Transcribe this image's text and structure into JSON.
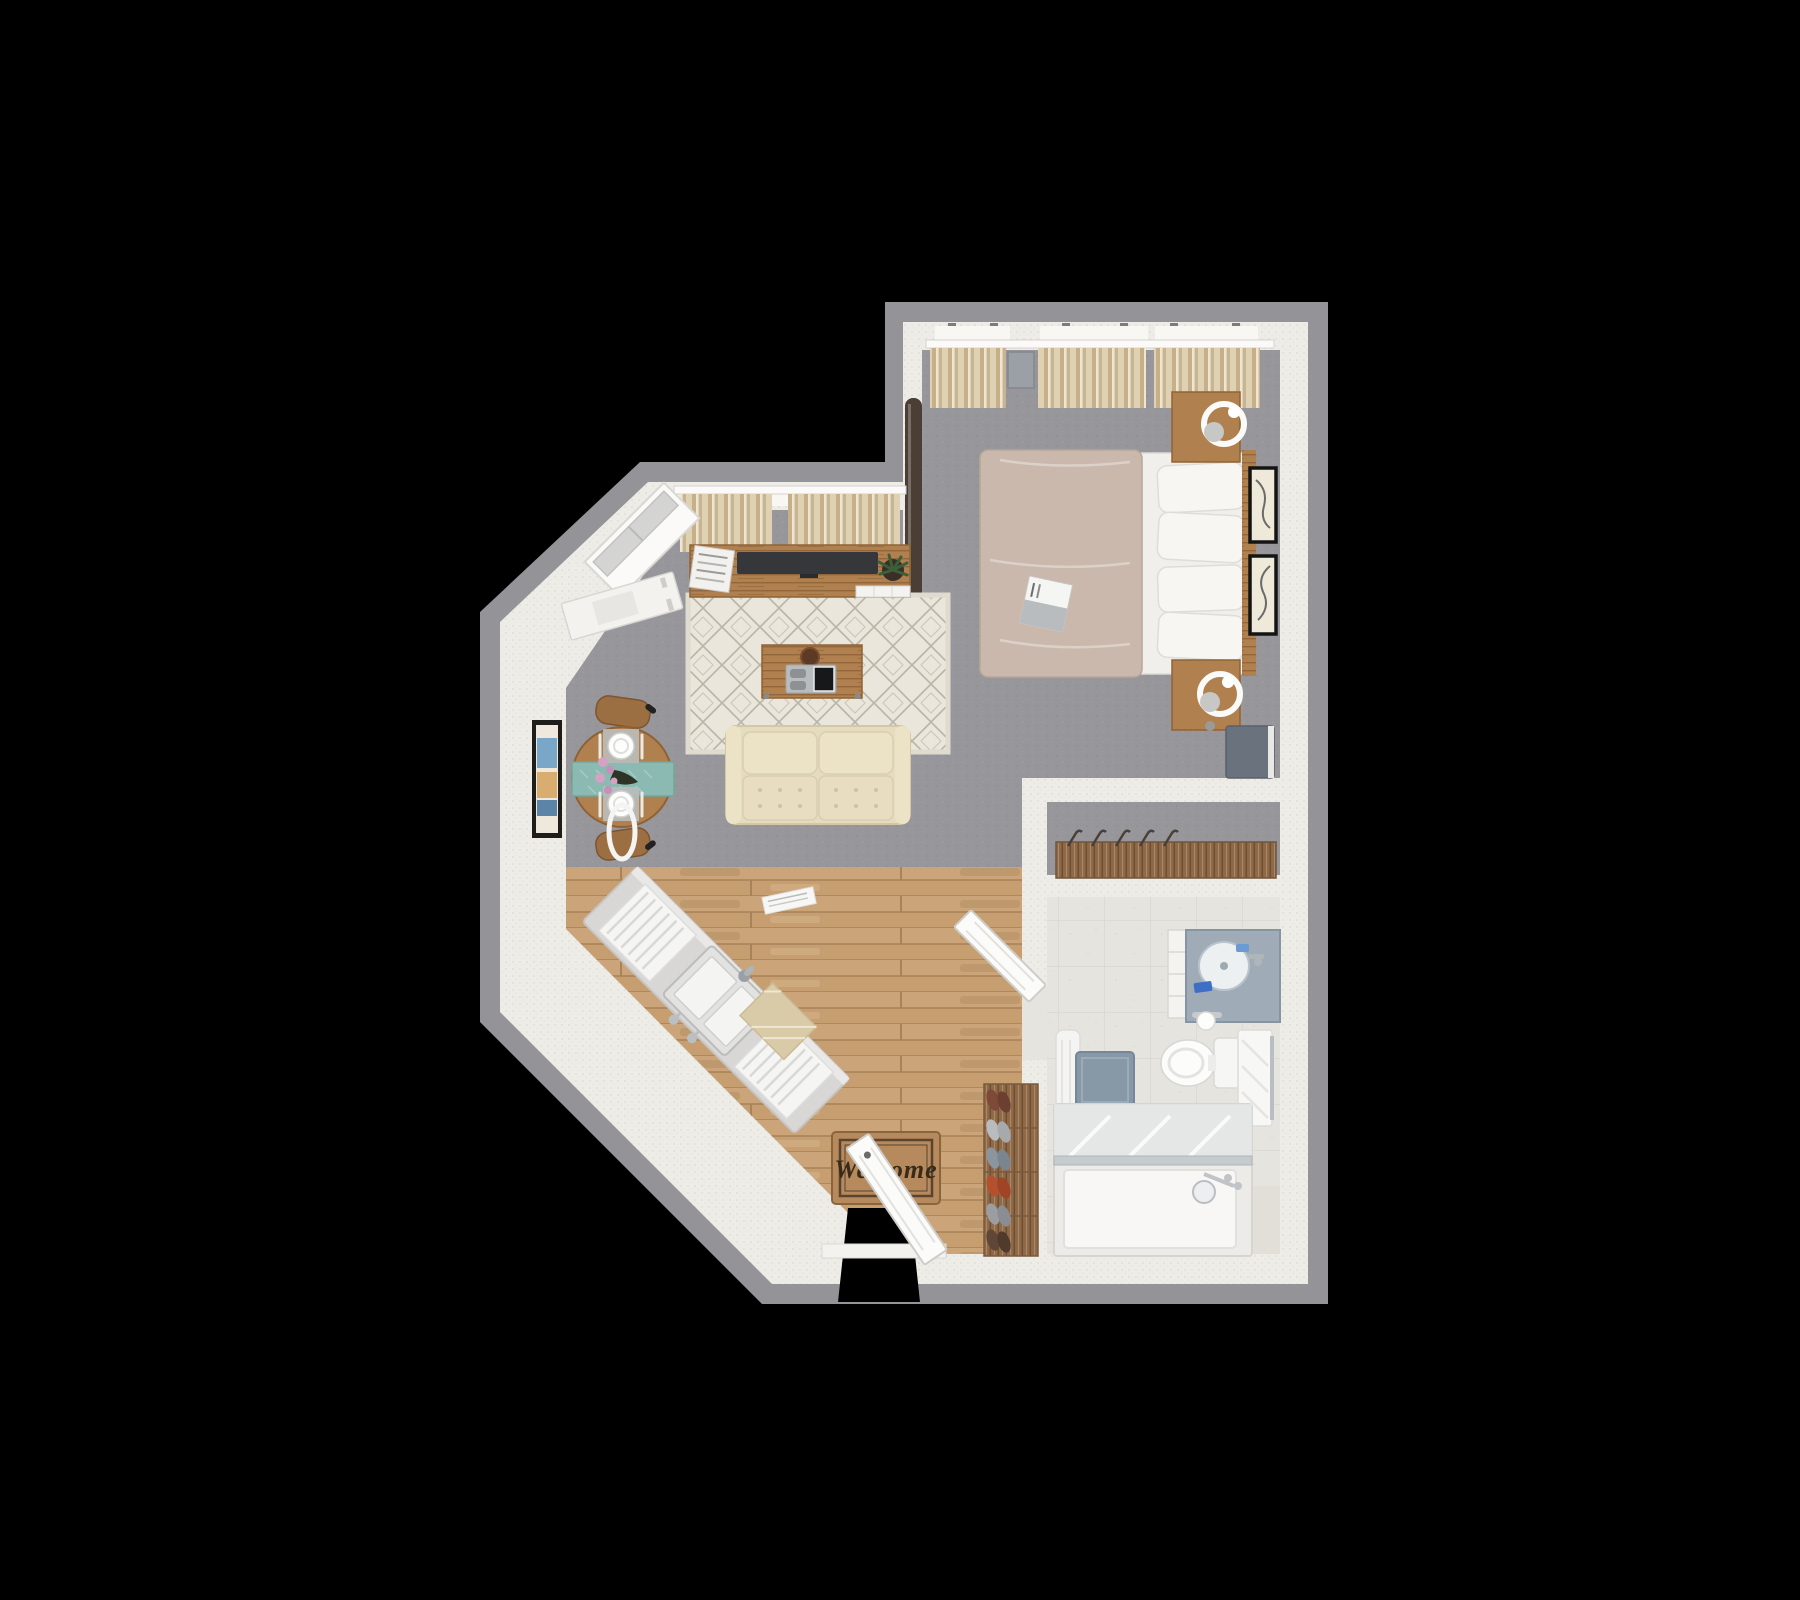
{
  "scene": {
    "description": "3D rendered top-down floor plan of a studio apartment on a black background",
    "background": "#000000"
  },
  "entry": {
    "mat_text": "Welcome"
  },
  "colors": {
    "background": "#000000",
    "shadow": "#949498",
    "wall": "#eeece7",
    "wall-stub": "#e2dfd8",
    "carpet": "#97979b",
    "wood-floor": "#c79e6f",
    "wood-floor-seam": "#a8825a",
    "tile": "#e6e4df",
    "tile-line": "#d8d6d1",
    "rug-base": "#eae6db",
    "rug-line": "#b9b5a8",
    "curtain-light": "#e0d1b2",
    "curtain-dark": "#c6b08a",
    "sofa": "#e5dbbf",
    "sofa-cushion": "#ece2c6",
    "furniture-wood": "#b0804e",
    "furniture-wood-dark": "#8f6236",
    "bed-duvet": "#c9b8ab",
    "mattress": "#f1efeb",
    "pillow": "#f7f6f2",
    "tv": "#36373a",
    "mirror": "#4a3e35",
    "runner-teal": "#8abab1",
    "flower-pink": "#d5a2c3",
    "counter": "#d8d7d5",
    "vanity-counter": "#9facb7",
    "bath-mat": "#8798a6",
    "glass": "#e2e6e7",
    "glass-frame": "#c6cbcf",
    "welcome-mat": "#b68a5c",
    "welcome-mat-border": "#5a4430",
    "dresser-panel": "#6a737d",
    "shoe-red": "#b5502e",
    "shoe-gray": "#9a9da1"
  },
  "rooms": {
    "bedroom": {
      "name": "Bedroom",
      "furniture": [
        "bed",
        "pillows",
        "duvet",
        "magazine",
        "nightstand-top",
        "nightstand-bottom",
        "lamp",
        "wall-frames",
        "curtains",
        "dresser-panel",
        "leaning-mirror"
      ]
    },
    "living": {
      "name": "Living Area",
      "furniture": [
        "tv-console",
        "tv",
        "plant",
        "newspapers",
        "area-rug",
        "coffee-table",
        "tray",
        "sofa",
        "dining-table",
        "table-runner",
        "plates",
        "flowers",
        "chairs",
        "white-desk",
        "wall-art",
        "window",
        "curtains"
      ]
    },
    "kitchen": {
      "name": "Kitchenette",
      "furniture": [
        "counter",
        "sink",
        "faucet",
        "dish-racks",
        "towel"
      ]
    },
    "closet": {
      "name": "Closet",
      "furniture": [
        "organizer",
        "hangers"
      ]
    },
    "bathroom": {
      "name": "Bathroom",
      "furniture": [
        "vanity",
        "sink",
        "toilet",
        "toilet-paper",
        "towel-rack",
        "robe",
        "bath-mat",
        "bathtub",
        "glass-screen",
        "shower-fixtures",
        "door"
      ]
    },
    "entry": {
      "name": "Entry",
      "furniture": [
        "welcome-mat",
        "entry-door",
        "shoe-rack"
      ]
    }
  }
}
